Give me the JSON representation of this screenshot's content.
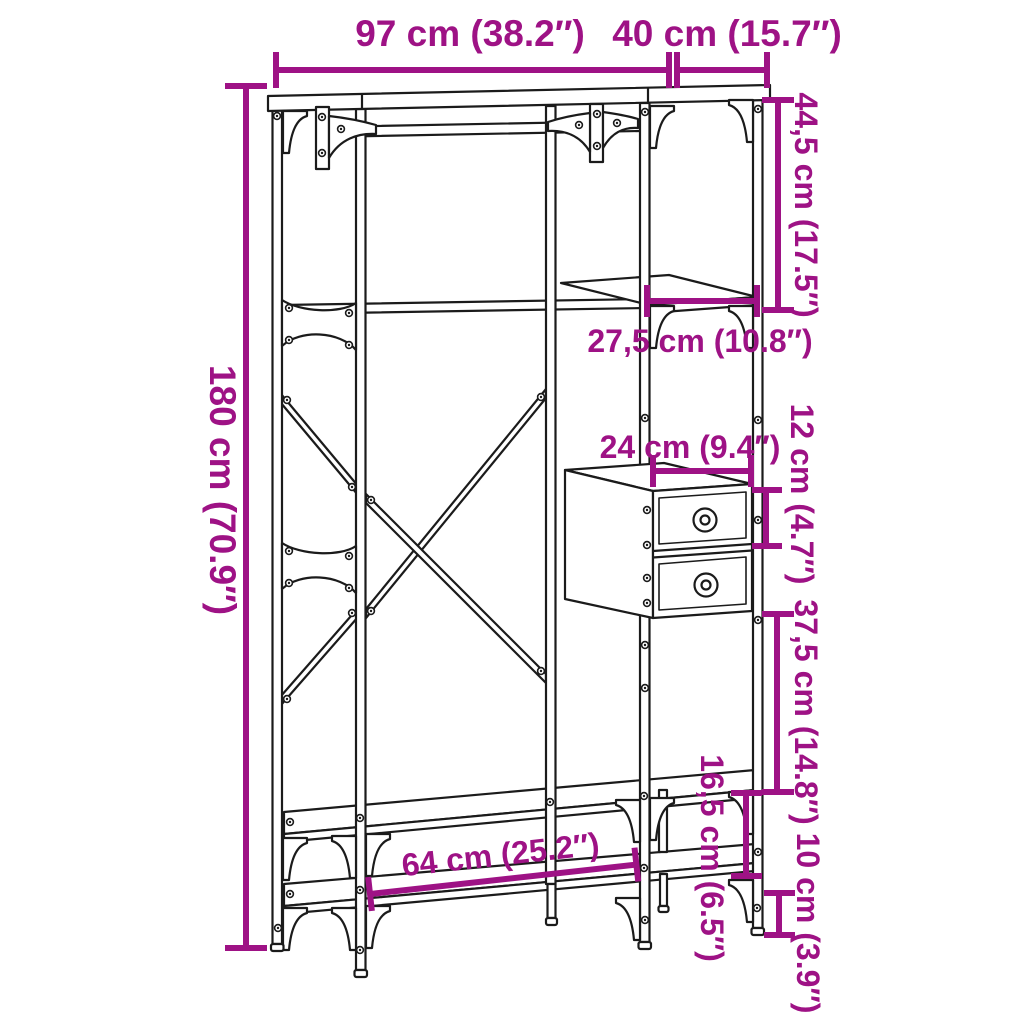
{
  "diagram": {
    "colors": {
      "dimension_accent": "#9E1285",
      "line_art": "#1B1B1B",
      "background": "#FFFFFF"
    },
    "labels": {
      "top_width": "97 cm (38.2″)",
      "top_depth": "40 cm (15.7″)",
      "total_height": "180 cm (70.9″)",
      "upper_shelf_section_height": "44,5 cm (17.5″)",
      "shelf_depth": "27,5 cm (10.8″)",
      "drawer_unit_width": "24 cm (9.4″)",
      "drawer_unit_height": "12 cm (4.7″)",
      "middle_section_height": "37,5 cm (14.8″)",
      "bench_gap_height": "16,5 cm (6.5″)",
      "foot_height": "10 cm (3.9″)",
      "bottom_shelf_width": "64 cm (25.2″)"
    }
  }
}
